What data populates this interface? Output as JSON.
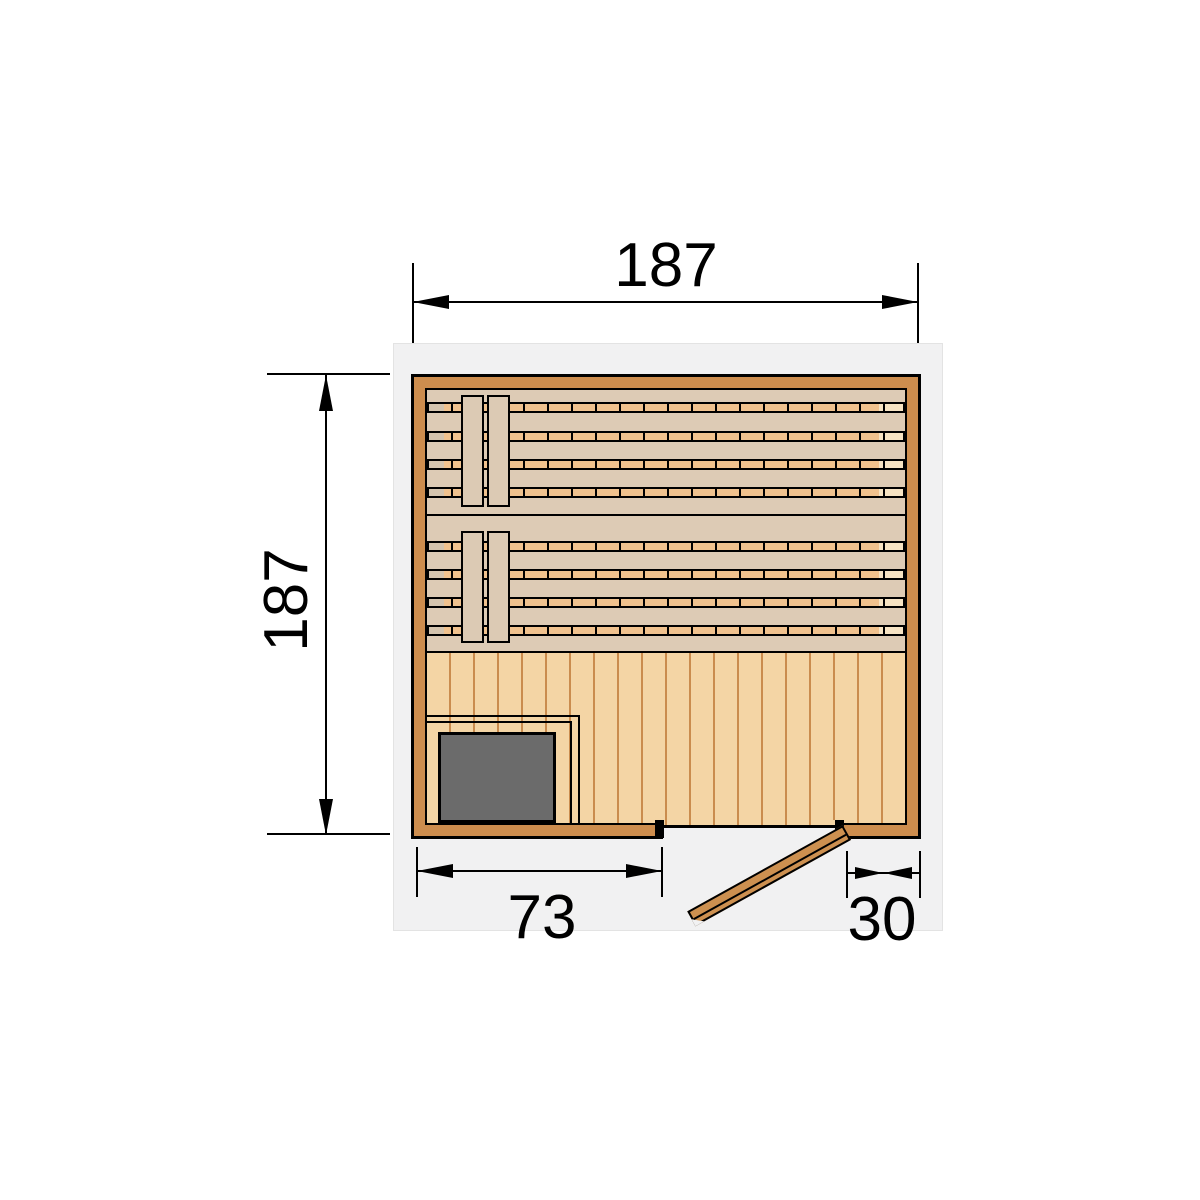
{
  "diagram": {
    "title": "sauna-floor-plan",
    "dimensions": {
      "width": "187",
      "depth": "187",
      "stove_section": "73",
      "door_section": "30"
    },
    "colors": {
      "page_bg": "#ffffff",
      "line": "#000000",
      "panel": "#f1f1f2",
      "panel_border": "#e3e3e3",
      "wall": "#cd8d4e",
      "interior": "#ddcbb5",
      "slat": "#f0c28e",
      "slat_end_left": "#d4c4ae",
      "slat_end_right": "#f6e3c3",
      "board": "#dccab4",
      "floor": "#f4d5a5",
      "floor_line": "#ca8c4e",
      "stove": "#6b6b6b",
      "door": "#cd9050"
    }
  }
}
